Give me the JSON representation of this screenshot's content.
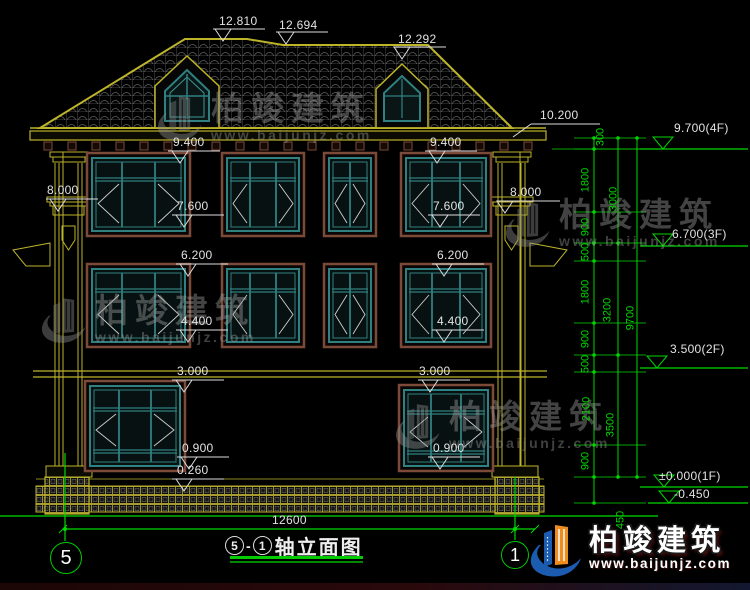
{
  "drawing": {
    "title": {
      "axis_start": "5",
      "separator": "-",
      "axis_end": "1",
      "name": "轴立面图"
    }
  },
  "dims": {
    "v12810": "12.810",
    "v12694": "12.694",
    "v12292": "12.292",
    "v10200": "10.200",
    "v9400": "9.400",
    "v8000": "8.000",
    "v7600": "7.600",
    "v6200": "6.200",
    "v4400": "4.400",
    "v3000": "3.000",
    "v0900": "0.900",
    "v0260": "0.260",
    "v12600": "12600"
  },
  "chain": {
    "s300": "300",
    "s1800a": "1800",
    "s900a": "900",
    "s500a": "500",
    "s1800b": "1800",
    "s900b": "900",
    "s500b": "500",
    "s2100": "2100",
    "s900c": "900",
    "s450": "450",
    "t3000": "3000",
    "t3200": "3200",
    "t3500": "3500",
    "total": "9700"
  },
  "elevations": {
    "f4": "9.700(4F)",
    "f3": "6.700(3F)",
    "f2": "3.500(2F)",
    "f1": "±0.000(1F)",
    "below": "-0.450"
  },
  "grid_bubbles": {
    "left": "5",
    "right": "1"
  },
  "watermark": {
    "brand": "柏竣建筑",
    "url": "www.baijunjz.com"
  },
  "logo": {
    "brand": "柏竣建筑",
    "url": "www.baijunjz.com"
  },
  "colors": {
    "background": "#000000",
    "dim_green": "#00d900",
    "building_yellow": "#bdb42a",
    "window_teal": "#2f8080",
    "frame_brown": "#7c4a38",
    "text": "#e8e8e8"
  }
}
